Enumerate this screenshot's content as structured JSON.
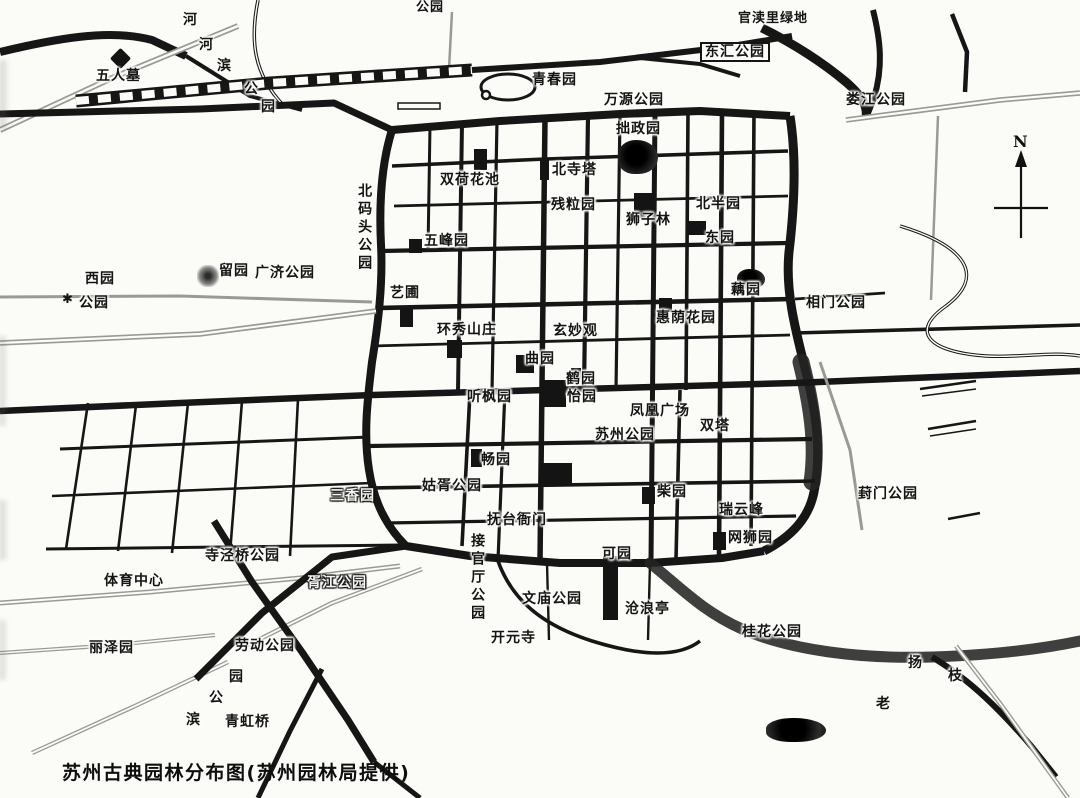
{
  "caption": "苏州古典园林分布图(苏州园林局提供)",
  "compass": {
    "label": "N"
  },
  "map": {
    "labels": [
      {
        "name": "wurenmu",
        "text": "五人墓",
        "x": 96,
        "y": 68
      },
      {
        "name": "riverside-park-char-1",
        "text": "河",
        "x": 183,
        "y": 12
      },
      {
        "name": "riverside-park-char-2",
        "text": "河",
        "x": 199,
        "y": 37
      },
      {
        "name": "riverside-park-char-3",
        "text": "滨",
        "x": 217,
        "y": 58
      },
      {
        "name": "riverside-park-char-4",
        "text": "公",
        "x": 244,
        "y": 81
      },
      {
        "name": "riverside-park-char-5",
        "text": "园",
        "x": 261,
        "y": 99
      },
      {
        "name": "clipped-park-top",
        "text": "公园",
        "x": 416,
        "y": 1,
        "size": 13
      },
      {
        "name": "qingchunyuan",
        "text": "青春园",
        "x": 532,
        "y": 72
      },
      {
        "name": "wanyuan-park",
        "text": "万源公园",
        "x": 604,
        "y": 92
      },
      {
        "name": "donghui-park",
        "text": "东汇公园",
        "x": 700,
        "y": 42,
        "style": "boxed"
      },
      {
        "name": "guanduli-green",
        "text": "官渎里绿地",
        "x": 738,
        "y": 12,
        "size": 13
      },
      {
        "name": "loujiang-park",
        "text": "娄江公园",
        "x": 846,
        "y": 92
      },
      {
        "name": "zhuozhengyuan",
        "text": "拙政园",
        "x": 616,
        "y": 121
      },
      {
        "name": "beisita",
        "text": "北寺塔",
        "x": 552,
        "y": 162
      },
      {
        "name": "shuanghehuachi",
        "text": "双荷花池",
        "x": 440,
        "y": 172
      },
      {
        "name": "canliyuan",
        "text": "残粒园",
        "x": 551,
        "y": 197
      },
      {
        "name": "shizilin",
        "text": "狮子林",
        "x": 626,
        "y": 212
      },
      {
        "name": "beibanyuan",
        "text": "北半园",
        "x": 696,
        "y": 196
      },
      {
        "name": "dongyuan",
        "text": "东园",
        "x": 705,
        "y": 230
      },
      {
        "name": "beimatou-park",
        "text": "北码头公园",
        "x": 356,
        "y": 183,
        "dir": "v"
      },
      {
        "name": "wufengyuan",
        "text": "五峰园",
        "x": 424,
        "y": 233
      },
      {
        "name": "liuyuan",
        "text": "留园",
        "x": 219,
        "y": 263
      },
      {
        "name": "guangji-park",
        "text": "广济公园",
        "x": 255,
        "y": 265
      },
      {
        "name": "xiyuan",
        "text": "西园",
        "x": 85,
        "y": 271
      },
      {
        "name": "xiyuan-park",
        "text": "公园",
        "x": 79,
        "y": 295
      },
      {
        "name": "ouyuan",
        "text": "藕园",
        "x": 731,
        "y": 282
      },
      {
        "name": "xiangmen-park",
        "text": "相门公园",
        "x": 806,
        "y": 295
      },
      {
        "name": "yipu",
        "text": "艺圃",
        "x": 390,
        "y": 285
      },
      {
        "name": "huanxiu-shanzhuang",
        "text": "环秀山庄",
        "x": 437,
        "y": 322
      },
      {
        "name": "xuanmiaoguan",
        "text": "玄妙观",
        "x": 553,
        "y": 323
      },
      {
        "name": "huiyin-garden",
        "text": "惠荫花园",
        "x": 656,
        "y": 310
      },
      {
        "name": "quyuan",
        "text": "曲园",
        "x": 525,
        "y": 351
      },
      {
        "name": "heyuan",
        "text": "鹤园",
        "x": 566,
        "y": 371
      },
      {
        "name": "yiyuan",
        "text": "怡园",
        "x": 567,
        "y": 389
      },
      {
        "name": "tingfengyuan",
        "text": "听枫园",
        "x": 467,
        "y": 389
      },
      {
        "name": "fenghuang-square",
        "text": "凤凰广场",
        "x": 630,
        "y": 403
      },
      {
        "name": "shuangta",
        "text": "双塔",
        "x": 700,
        "y": 418
      },
      {
        "name": "suzhou-park",
        "text": "苏州公园",
        "x": 595,
        "y": 427
      },
      {
        "name": "changyuan",
        "text": "畅园",
        "x": 481,
        "y": 452
      },
      {
        "name": "sanxiangyuan",
        "text": "三香园",
        "x": 330,
        "y": 488,
        "style": "outline"
      },
      {
        "name": "guxu-park",
        "text": "姑胥公园",
        "x": 422,
        "y": 478
      },
      {
        "name": "chaiyuan",
        "text": "柴园",
        "x": 657,
        "y": 484
      },
      {
        "name": "ruiyunfeng",
        "text": "瑞云峰",
        "x": 719,
        "y": 502
      },
      {
        "name": "wangshiyuan",
        "text": "网狮园",
        "x": 728,
        "y": 530
      },
      {
        "name": "fengmen-park",
        "text": "葑门公园",
        "x": 858,
        "y": 486
      },
      {
        "name": "futai-yamen",
        "text": "抚台衙门",
        "x": 487,
        "y": 512
      },
      {
        "name": "jieguanting-park",
        "text": "接官厅公园",
        "x": 469,
        "y": 533,
        "dir": "v"
      },
      {
        "name": "keyuan",
        "text": "可园",
        "x": 602,
        "y": 546
      },
      {
        "name": "wenmiao-park",
        "text": "文庙公园",
        "x": 522,
        "y": 591
      },
      {
        "name": "canglangting",
        "text": "沧浪亭",
        "x": 625,
        "y": 601
      },
      {
        "name": "kaiyuansi",
        "text": "开元寺",
        "x": 491,
        "y": 630
      },
      {
        "name": "sijingqiao-park",
        "text": "寺泾桥公园",
        "x": 205,
        "y": 548
      },
      {
        "name": "sports-center",
        "text": "体育中心",
        "x": 104,
        "y": 573
      },
      {
        "name": "xujiang-park",
        "text": "胥江公园",
        "x": 307,
        "y": 575,
        "style": "outline"
      },
      {
        "name": "lizeyuan",
        "text": "丽泽园",
        "x": 89,
        "y": 640
      },
      {
        "name": "laodong-park",
        "text": "劳动公园",
        "x": 235,
        "y": 638
      },
      {
        "name": "bin-park-char-1",
        "text": "园",
        "x": 229,
        "y": 669
      },
      {
        "name": "bin-park-char-2",
        "text": "公",
        "x": 209,
        "y": 690
      },
      {
        "name": "bin-park-char-3",
        "text": "滨",
        "x": 186,
        "y": 712
      },
      {
        "name": "qinghongqiao",
        "text": "青虹桥",
        "x": 225,
        "y": 714
      },
      {
        "name": "guihua-park",
        "text": "桂花公园",
        "x": 742,
        "y": 624
      },
      {
        "name": "yangzhi-char-1",
        "text": "扬",
        "x": 908,
        "y": 655
      },
      {
        "name": "yangzhi-char-2",
        "text": "枝",
        "x": 948,
        "y": 668
      },
      {
        "name": "lao-char",
        "text": "老",
        "x": 876,
        "y": 696
      }
    ],
    "markers": [
      {
        "name": "wurenmu-tomb-marker",
        "shape": "diamond",
        "x": 113,
        "y": 51,
        "w": 15,
        "h": 15
      },
      {
        "name": "liuyuan-marker",
        "shape": "glow",
        "x": 197,
        "y": 265,
        "w": 22,
        "h": 22
      },
      {
        "name": "zhuozhengyuan-marker",
        "shape": "blob",
        "x": 618,
        "y": 140,
        "w": 40,
        "h": 34
      },
      {
        "name": "shizilin-marker",
        "shape": "rect",
        "x": 634,
        "y": 193,
        "w": 21,
        "h": 25
      },
      {
        "name": "beisita-marker",
        "shape": "rect",
        "x": 540,
        "y": 158,
        "w": 9,
        "h": 22
      },
      {
        "name": "shuanghehuachi-marker",
        "shape": "rect",
        "x": 474,
        "y": 149,
        "w": 13,
        "h": 21
      },
      {
        "name": "wufengyuan-marker",
        "shape": "rect",
        "x": 409,
        "y": 239,
        "w": 13,
        "h": 14
      },
      {
        "name": "yipu-marker",
        "shape": "rect",
        "x": 400,
        "y": 309,
        "w": 13,
        "h": 18
      },
      {
        "name": "huanxiu-marker",
        "shape": "rect",
        "x": 447,
        "y": 340,
        "w": 15,
        "h": 18
      },
      {
        "name": "quyuan-marker",
        "shape": "rect",
        "x": 516,
        "y": 355,
        "w": 18,
        "h": 18
      },
      {
        "name": "yiyuan-heyuan-marker",
        "shape": "rect",
        "x": 540,
        "y": 380,
        "w": 26,
        "h": 27
      },
      {
        "name": "guanqian-block-marker",
        "shape": "rect",
        "x": 571,
        "y": 368,
        "w": 10,
        "h": 11
      },
      {
        "name": "changyuan-marker",
        "shape": "rect",
        "x": 471,
        "y": 449,
        "w": 11,
        "h": 18
      },
      {
        "name": "nanhao-block-marker",
        "shape": "rect",
        "x": 539,
        "y": 463,
        "w": 33,
        "h": 23
      },
      {
        "name": "chaiyuan-marker",
        "shape": "rect",
        "x": 642,
        "y": 487,
        "w": 13,
        "h": 17
      },
      {
        "name": "wangshiyuan-marker",
        "shape": "rect",
        "x": 713,
        "y": 532,
        "w": 13,
        "h": 18
      },
      {
        "name": "huiyin-marker",
        "shape": "rect",
        "x": 659,
        "y": 298,
        "w": 13,
        "h": 14
      },
      {
        "name": "ouyuan-marker",
        "shape": "blob",
        "x": 737,
        "y": 269,
        "w": 28,
        "h": 20
      },
      {
        "name": "beibanyuan-marker",
        "shape": "rect",
        "x": 688,
        "y": 221,
        "w": 18,
        "h": 14
      },
      {
        "name": "fuxue-strip-marker",
        "shape": "rect",
        "x": 603,
        "y": 556,
        "w": 15,
        "h": 64
      },
      {
        "name": "se-lake-marker",
        "shape": "blob",
        "x": 766,
        "y": 718,
        "w": 60,
        "h": 24
      },
      {
        "name": "temple-asterisk-marker",
        "shape": "star",
        "x": 62,
        "y": 293,
        "w": 14,
        "h": 14,
        "glyph": "✱"
      }
    ]
  }
}
